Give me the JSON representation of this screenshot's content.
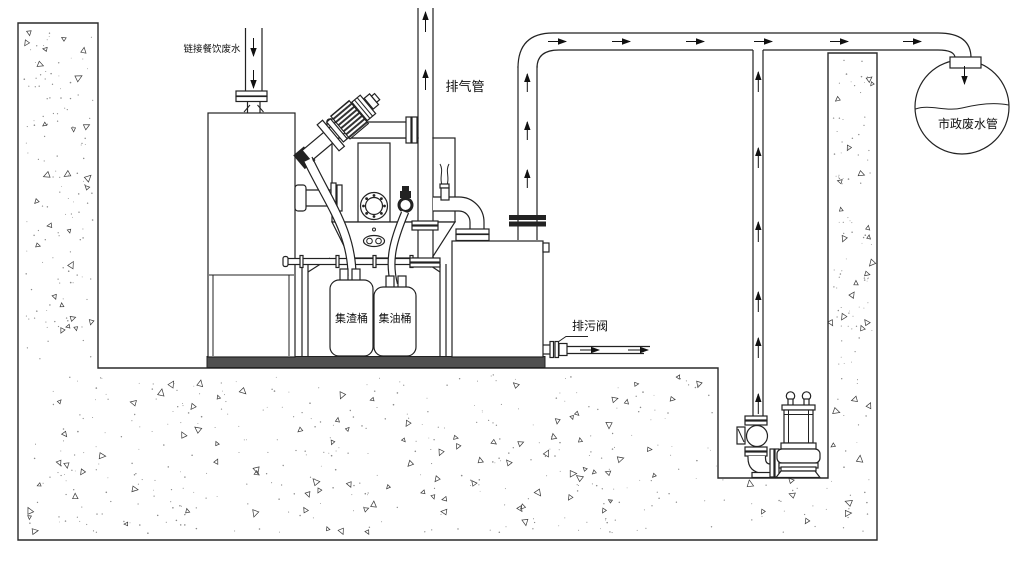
{
  "labels": {
    "inlet": "链接餐饮废水",
    "vent": "排气管",
    "slag_bucket": "集渣桶",
    "oil_bucket": "集油桶",
    "drain_valve": "排污阀",
    "municipal": "市政废水管"
  },
  "colors": {
    "line": "#222222",
    "base_plate": "#4f4f4f",
    "background": "#ffffff",
    "hatch_triangle": "#3a3a3a",
    "hatch_dot": "#8a8a8a"
  }
}
